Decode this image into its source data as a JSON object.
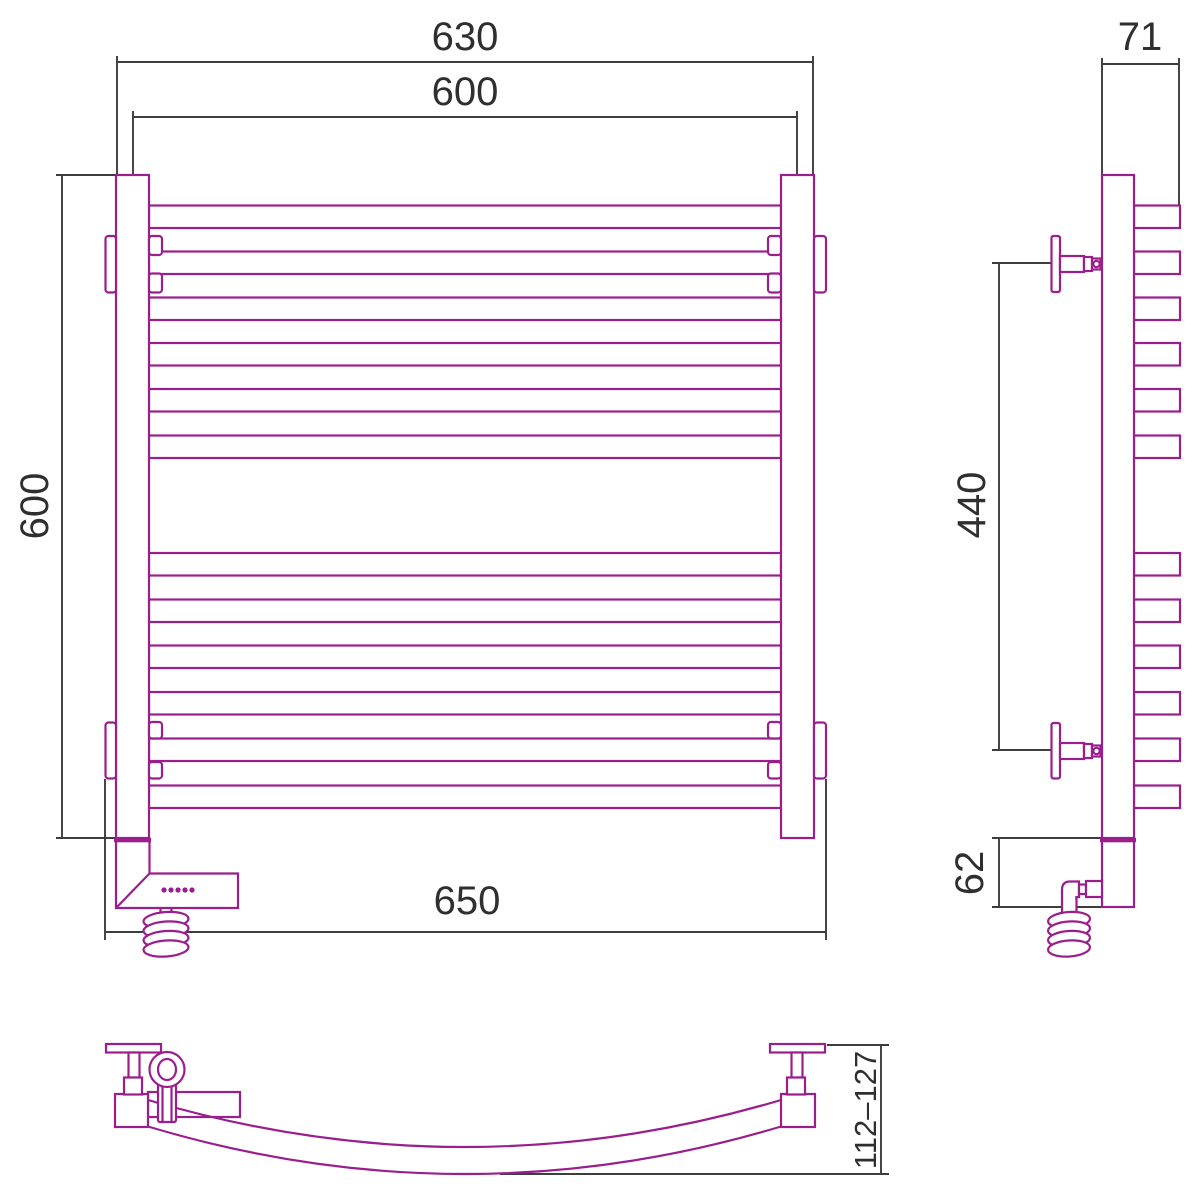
{
  "drawing": {
    "type": "towel-rail-technical-drawing",
    "views": [
      "front",
      "side",
      "plan-bottom"
    ]
  },
  "labels": {
    "front_width_outer": "630",
    "front_width_centers": "600",
    "front_height": "600",
    "front_width_brackets": "650",
    "side_depth": "71",
    "side_bracket_spacing": "440",
    "side_unit_height": "62",
    "plan_wall_offset": "112–127"
  },
  "front": {
    "rung_count": 12,
    "rung_tops": [
      205.5,
      251.5,
      297.5,
      343,
      389,
      435.5,
      553,
      599.5,
      645.5,
      692,
      738.5,
      785.5
    ],
    "rung_height": 22.5,
    "rung_x": 149,
    "rung_width": 632,
    "indicator_dots": {
      "count": 5,
      "start_x": 164,
      "step": 7,
      "y": 890,
      "r": 2.6
    },
    "coil": {
      "cx": 166,
      "tops": [
        920,
        929.5,
        939,
        948.5
      ],
      "rx": 22.5,
      "ry": 8
    }
  },
  "side": {
    "rung_x": 1134,
    "rung_depth": 46,
    "coil": {
      "cx": 1069,
      "tops": [
        920,
        929.5,
        939,
        948.5
      ],
      "rx": 21,
      "ry": 8
    }
  },
  "colors": {
    "product_outline": "#9A1E8C",
    "dimension_lines": "#3D3D3D",
    "text": "#2F2F2F",
    "background": "#FFFFFF"
  }
}
